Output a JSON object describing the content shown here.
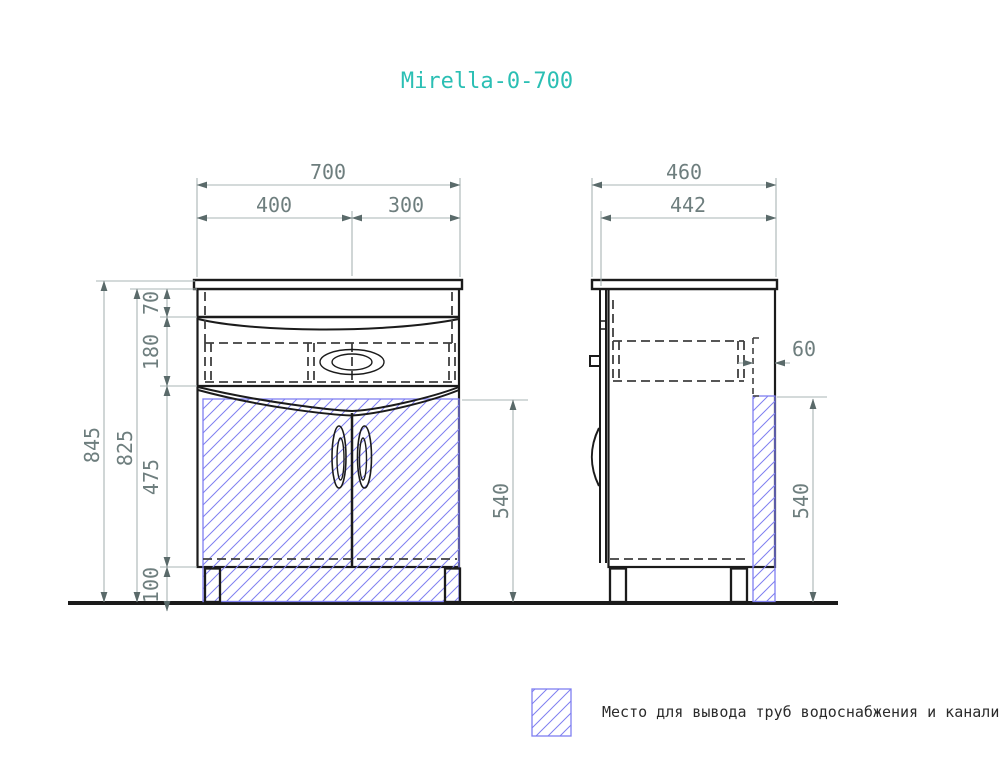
{
  "title": "Mirella-0-700",
  "colors": {
    "accent": "#2bbfb4",
    "dim-text": "#6e7e7e",
    "dim-line": "#a9b4b4",
    "arrow": "#5a6a6a",
    "outline": "#1b1b1b",
    "hidden": "#3f3f3f",
    "hatch": "#7f7ff0",
    "legend-text": "#2b2b2b",
    "background": "#ffffff"
  },
  "front_view": {
    "dim_total_width": "700",
    "dim_left_width": "400",
    "dim_right_width": "300",
    "dim_overall_height": "845",
    "dim_body_height": "825",
    "dim_top_section": "70",
    "dim_drawer_section": "180",
    "dim_door_section": "475",
    "dim_plinth_height": "100",
    "dim_pipe_zone_height": "540"
  },
  "side_view": {
    "dim_total_depth": "460",
    "dim_body_depth": "442",
    "dim_pipe_zone_width": "60",
    "dim_pipe_zone_height": "540"
  },
  "legend": {
    "label": "Место для вывода труб водоснабжения и канализации"
  }
}
